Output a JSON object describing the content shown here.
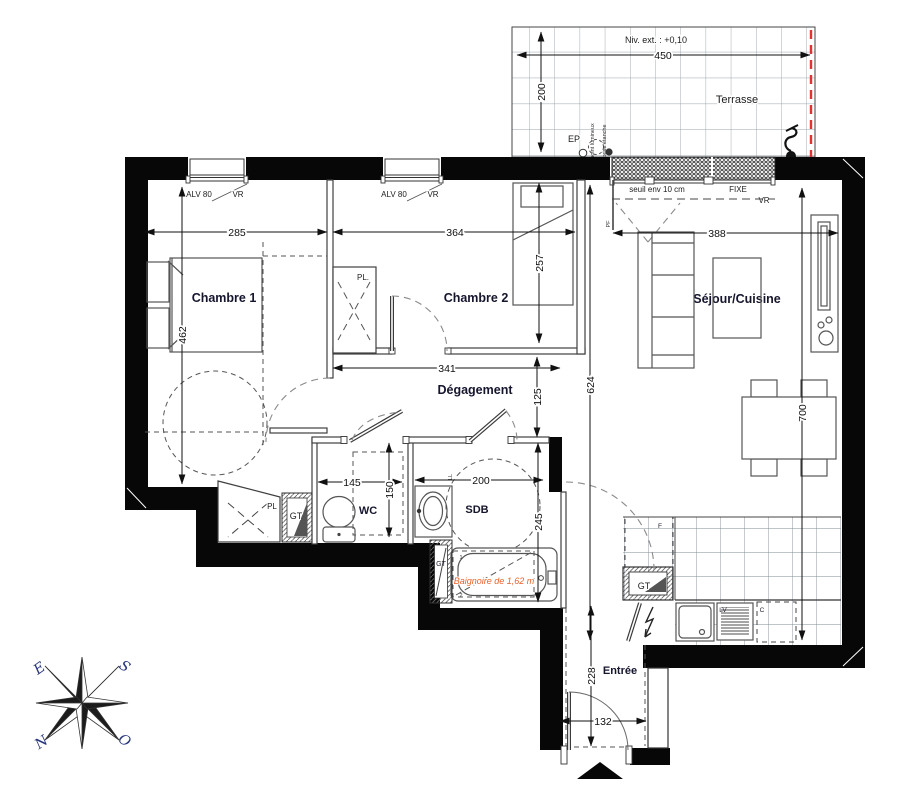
{
  "rooms": {
    "chambre1": "Chambre 1",
    "chambre2": "Chambre 2",
    "sejour": "Séjour/Cuisine",
    "degagement": "Dégagement",
    "wc": "WC",
    "sdb": "SDB",
    "entree": "Entrée",
    "terrasse": "Terrasse"
  },
  "terrace": {
    "niv": "Niv. ext. : +0,10",
    "ep": "EP",
    "point_lumineux": "point lumineux",
    "prise_etanche": "prise étanche"
  },
  "door": {
    "seuil": "seuil env 10 cm",
    "fixe": "FIXE",
    "vr": "VR",
    "pf": "PF"
  },
  "windows": {
    "alv": "ALV 80",
    "vr": "VR"
  },
  "closets": {
    "pl_dot": "PL.",
    "pl": "PL",
    "gt": "GT"
  },
  "kitchen": {
    "lv": "LV",
    "c": "C",
    "f": "F"
  },
  "bath": {
    "baignoire": "Baignoire de  1,62 m",
    "n1": "1",
    "n2": "2",
    "ll": "LL"
  },
  "dims": {
    "d450": "450",
    "d200t": "200",
    "d285": "285",
    "d364": "364",
    "d388": "388",
    "d462": "462",
    "d257": "257",
    "d624": "624",
    "d700": "700",
    "d341": "341",
    "d125": "125",
    "d145": "145",
    "d150": "150",
    "d200s": "200",
    "d245": "245",
    "d228": "228",
    "d132": "132"
  },
  "compass": {
    "e": "E",
    "s": "S",
    "n": "N",
    "o": "O"
  },
  "colors": {
    "wall": "#070707",
    "accent_red": "#e23333",
    "accent_orange": "#e8632a",
    "label_navy": "#15152e"
  }
}
